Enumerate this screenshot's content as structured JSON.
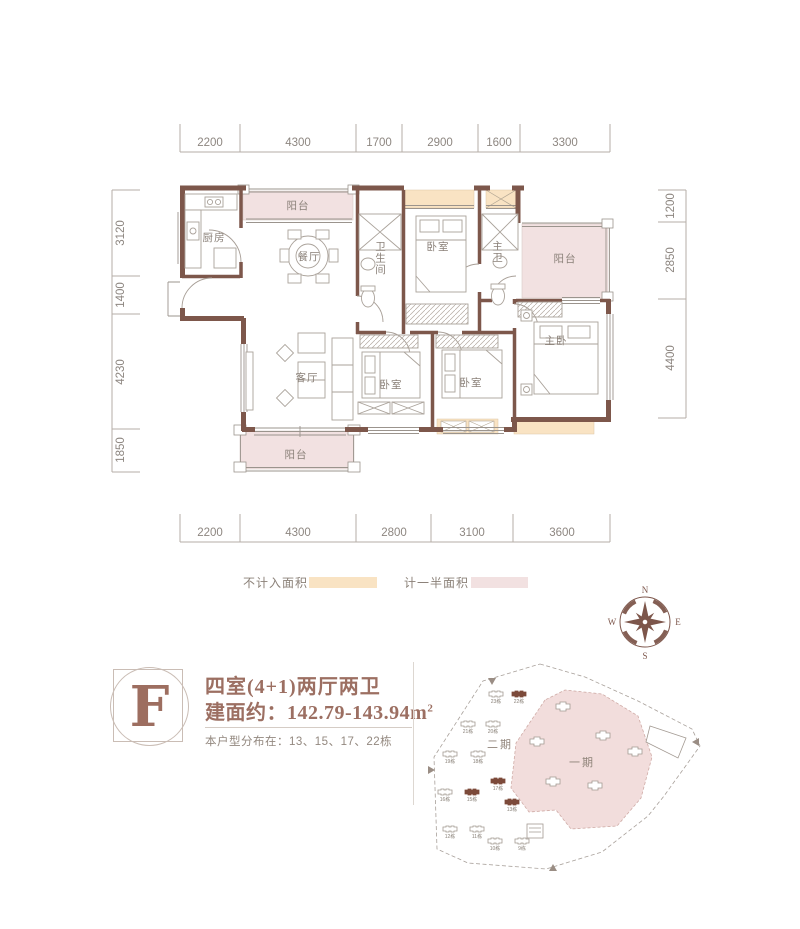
{
  "floorplan": {
    "dims_top": [
      "2200",
      "4300",
      "1700",
      "2900",
      "1600",
      "3300"
    ],
    "dims_bottom": [
      "2200",
      "4300",
      "2800",
      "3100",
      "3600"
    ],
    "dims_left": [
      "3120",
      "1400",
      "4230",
      "1850"
    ],
    "dims_right": [
      "1200",
      "2850",
      "4400"
    ],
    "rooms": {
      "balcony_top": "阳台",
      "kitchen": "厨房",
      "dining": "餐厅",
      "bathroom": "卫生间",
      "bedroom_top": "卧室",
      "master_bath": "主卫",
      "balcony_right": "阳台",
      "living": "客厅",
      "bedroom_left": "卧室",
      "bedroom_right": "卧室",
      "master_bedroom": "主卧",
      "balcony_bottom": "阳台"
    }
  },
  "legend": {
    "not_counted_label": "不计入面积",
    "not_counted_color": "#f9e3c3",
    "half_counted_label": "计一半面积",
    "half_counted_color": "#f2e1e1"
  },
  "compass": {
    "north": "N",
    "east": "E",
    "south": "S",
    "west": "W"
  },
  "unit": {
    "letter": "F",
    "layout_title": "四室(4+1)两厅两卫",
    "area_text": "建面约：142.79-143.94m",
    "area_sup": "2",
    "distribution": "本户型分布在：13、15、17、22栋"
  },
  "siteplan": {
    "phase1_label": "一期",
    "phase2_label": "二期",
    "buildings": [
      {
        "label": "23栋",
        "highlighted": false
      },
      {
        "label": "22栋",
        "highlighted": true
      },
      {
        "label": "21栋",
        "highlighted": false
      },
      {
        "label": "20栋",
        "highlighted": false
      },
      {
        "label": "19栋",
        "highlighted": false
      },
      {
        "label": "18栋",
        "highlighted": false
      },
      {
        "label": "17栋",
        "highlighted": true
      },
      {
        "label": "16栋",
        "highlighted": false
      },
      {
        "label": "15栋",
        "highlighted": true
      },
      {
        "label": "13栋",
        "highlighted": true
      },
      {
        "label": "12栋",
        "highlighted": false
      },
      {
        "label": "11栋",
        "highlighted": false
      },
      {
        "label": "10栋",
        "highlighted": false
      },
      {
        "label": "9栋",
        "highlighted": false
      }
    ]
  },
  "colors": {
    "wall": "#7d574b",
    "accent_text": "#9c6f62",
    "dim_text": "#8d8680",
    "room_text": "#8a8078",
    "site_phase1_fill": "#f2dddc"
  }
}
